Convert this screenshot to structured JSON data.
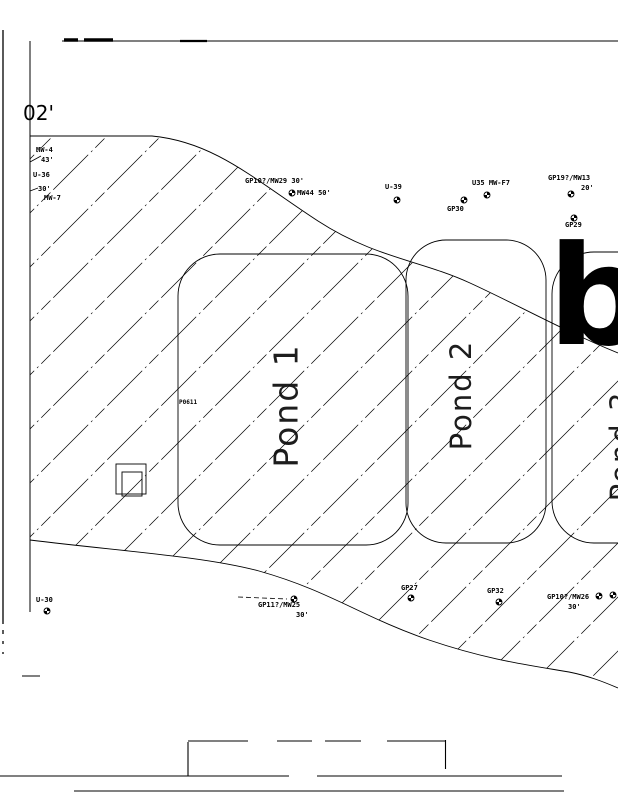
{
  "page": {
    "background": "#ffffff",
    "ink": "#000000"
  },
  "icons": {
    "well_marker": "well-marker-icon"
  },
  "scale_note": {
    "text": "02'"
  },
  "big_letter": {
    "text": "b"
  },
  "labels": [
    {
      "name": "label-02ft",
      "text": "02'",
      "x": 23,
      "y": 103,
      "size": 20,
      "cls": "scale-label"
    },
    {
      "name": "label-mw4",
      "text": "MW-4",
      "x": 36,
      "y": 147,
      "size": 7
    },
    {
      "name": "label-43ft",
      "text": "43'",
      "x": 41,
      "y": 157,
      "size": 7
    },
    {
      "name": "label-u36",
      "text": "U-36",
      "x": 33,
      "y": 172,
      "size": 7
    },
    {
      "name": "label-30ft-a",
      "text": "30'",
      "x": 38,
      "y": 186,
      "size": 7
    },
    {
      "name": "label-mw7",
      "text": "MW-7",
      "x": 44,
      "y": 195,
      "size": 7
    },
    {
      "name": "label-gp10-mw29",
      "text": "GP10?/MW29 30'",
      "x": 245,
      "y": 178,
      "size": 7
    },
    {
      "name": "label-mw44",
      "text": "MW44 50'",
      "x": 297,
      "y": 190,
      "size": 7
    },
    {
      "name": "label-u39",
      "text": "U-39",
      "x": 385,
      "y": 184,
      "size": 7
    },
    {
      "name": "label-u35-mwf7",
      "text": "U35 MW-F7",
      "x": 472,
      "y": 180,
      "size": 7
    },
    {
      "name": "label-gp30",
      "text": "GP30",
      "x": 447,
      "y": 206,
      "size": 7
    },
    {
      "name": "label-gp19-mw13",
      "text": "GP19?/MW13",
      "x": 548,
      "y": 175,
      "size": 7
    },
    {
      "name": "label-20ft",
      "text": "20'",
      "x": 581,
      "y": 185,
      "size": 7
    },
    {
      "name": "label-gp29",
      "text": "GP29",
      "x": 565,
      "y": 222,
      "size": 7
    },
    {
      "name": "label-p0611",
      "text": "P0611",
      "x": 179,
      "y": 400,
      "size": 6
    },
    {
      "name": "label-u30",
      "text": "U-30",
      "x": 36,
      "y": 597,
      "size": 7
    },
    {
      "name": "label-gp11-mw25",
      "text": "GP11?/MW25",
      "x": 258,
      "y": 602,
      "size": 7
    },
    {
      "name": "label-30ft-b",
      "text": "30'",
      "x": 296,
      "y": 612,
      "size": 7
    },
    {
      "name": "label-gp27",
      "text": "GP27",
      "x": 401,
      "y": 585,
      "size": 7
    },
    {
      "name": "label-gp32",
      "text": "GP32",
      "x": 487,
      "y": 588,
      "size": 7
    },
    {
      "name": "label-gp10-mw26",
      "text": "GP10?/MW26",
      "x": 547,
      "y": 594,
      "size": 7
    },
    {
      "name": "label-30ft-c",
      "text": "30'",
      "x": 568,
      "y": 604,
      "size": 7
    }
  ],
  "pond_labels": [
    {
      "name": "pond-1-label",
      "text": "Pond 1",
      "cx": 286,
      "cy": 402,
      "size": 33
    },
    {
      "name": "pond-2-label",
      "text": "Pond 2",
      "cx": 461,
      "cy": 392,
      "size": 29
    },
    {
      "name": "pond-3-label",
      "text": "Pond 3",
      "cx": 621,
      "cy": 443,
      "size": 29
    }
  ],
  "wells": [
    {
      "x": 292,
      "y": 193
    },
    {
      "x": 397,
      "y": 200
    },
    {
      "x": 487,
      "y": 195
    },
    {
      "x": 464,
      "y": 200
    },
    {
      "x": 571,
      "y": 194
    },
    {
      "x": 574,
      "y": 218
    },
    {
      "x": 47,
      "y": 611
    },
    {
      "x": 294,
      "y": 599
    },
    {
      "x": 411,
      "y": 598
    },
    {
      "x": 499,
      "y": 602
    },
    {
      "x": 599,
      "y": 596
    },
    {
      "x": 613,
      "y": 595
    }
  ]
}
